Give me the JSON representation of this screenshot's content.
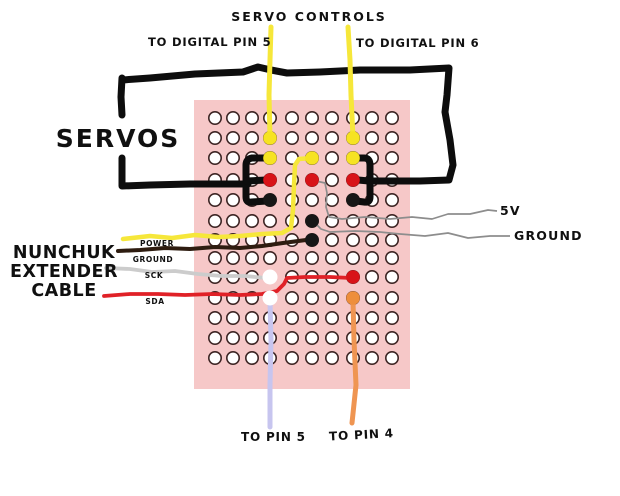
{
  "diagram": {
    "title": "SERVO CONTROLS",
    "labels": {
      "to_digital_pin_5": "TO DIGITAL PIN 5",
      "to_digital_pin_6": "TO DIGITAL PIN 6",
      "servos": "SERVOS",
      "nunchuk": [
        "NUNCHUK",
        "EXTENDER",
        "CABLE"
      ],
      "wire_power": "POWER",
      "wire_ground": "GROUND",
      "wire_sck": "SCK",
      "wire_sda": "SDA",
      "right_5v": "5V",
      "right_ground": "GROUND",
      "to_pin_5": "TO PIN 5",
      "to_pin_4": "TO PIN 4"
    }
  },
  "colors": {
    "background": "#ffffff",
    "text": "#101010",
    "board_pink": "#f6c8c8",
    "hole_fill": "#ffffff",
    "hole_ring": "#3d2524",
    "wire_black": "#0d0d0d",
    "wire_yellow": "#f6e73a",
    "wire_thin_gray": "#8d8d8d",
    "wire_light_gray": "#cccccc",
    "wire_dark_ground": "#2e1c10",
    "wire_red": "#e02127",
    "wire_lavender": "#c7c5ef",
    "wire_orange": "#ef9552",
    "dot_yellow": "#f6e322",
    "dot_red": "#d81318",
    "dot_black": "#171717",
    "dot_white": "#ffffff",
    "dot_orange": "#ee8e3c"
  },
  "board": {
    "cols": [
      215,
      233,
      252,
      270,
      292,
      312,
      332,
      353,
      372,
      392
    ],
    "rows": [
      118,
      138,
      158,
      180,
      200,
      221,
      240,
      258,
      277,
      298,
      318,
      338,
      358
    ],
    "x": 194,
    "y": 100,
    "width": 216,
    "height": 289,
    "hole_radius": 6.2,
    "dot_radius": 6.8,
    "solder_points": [
      {
        "row": 2,
        "col": 4,
        "color": "yellow"
      },
      {
        "row": 2,
        "col": 8,
        "color": "yellow"
      },
      {
        "row": 3,
        "col": 4,
        "color": "yellow"
      },
      {
        "row": 3,
        "col": 6,
        "color": "yellow"
      },
      {
        "row": 3,
        "col": 8,
        "color": "yellow"
      },
      {
        "row": 4,
        "col": 4,
        "color": "red"
      },
      {
        "row": 4,
        "col": 6,
        "color": "red"
      },
      {
        "row": 4,
        "col": 8,
        "color": "red"
      },
      {
        "row": 5,
        "col": 4,
        "color": "black"
      },
      {
        "row": 5,
        "col": 8,
        "color": "black"
      },
      {
        "row": 6,
        "col": 6,
        "color": "black"
      },
      {
        "row": 7,
        "col": 6,
        "color": "black"
      },
      {
        "row": 9,
        "col": 4,
        "color": "white"
      },
      {
        "row": 9,
        "col": 8,
        "color": "red"
      },
      {
        "row": 10,
        "col": 4,
        "color": "white"
      },
      {
        "row": 10,
        "col": 8,
        "color": "orange"
      }
    ]
  }
}
